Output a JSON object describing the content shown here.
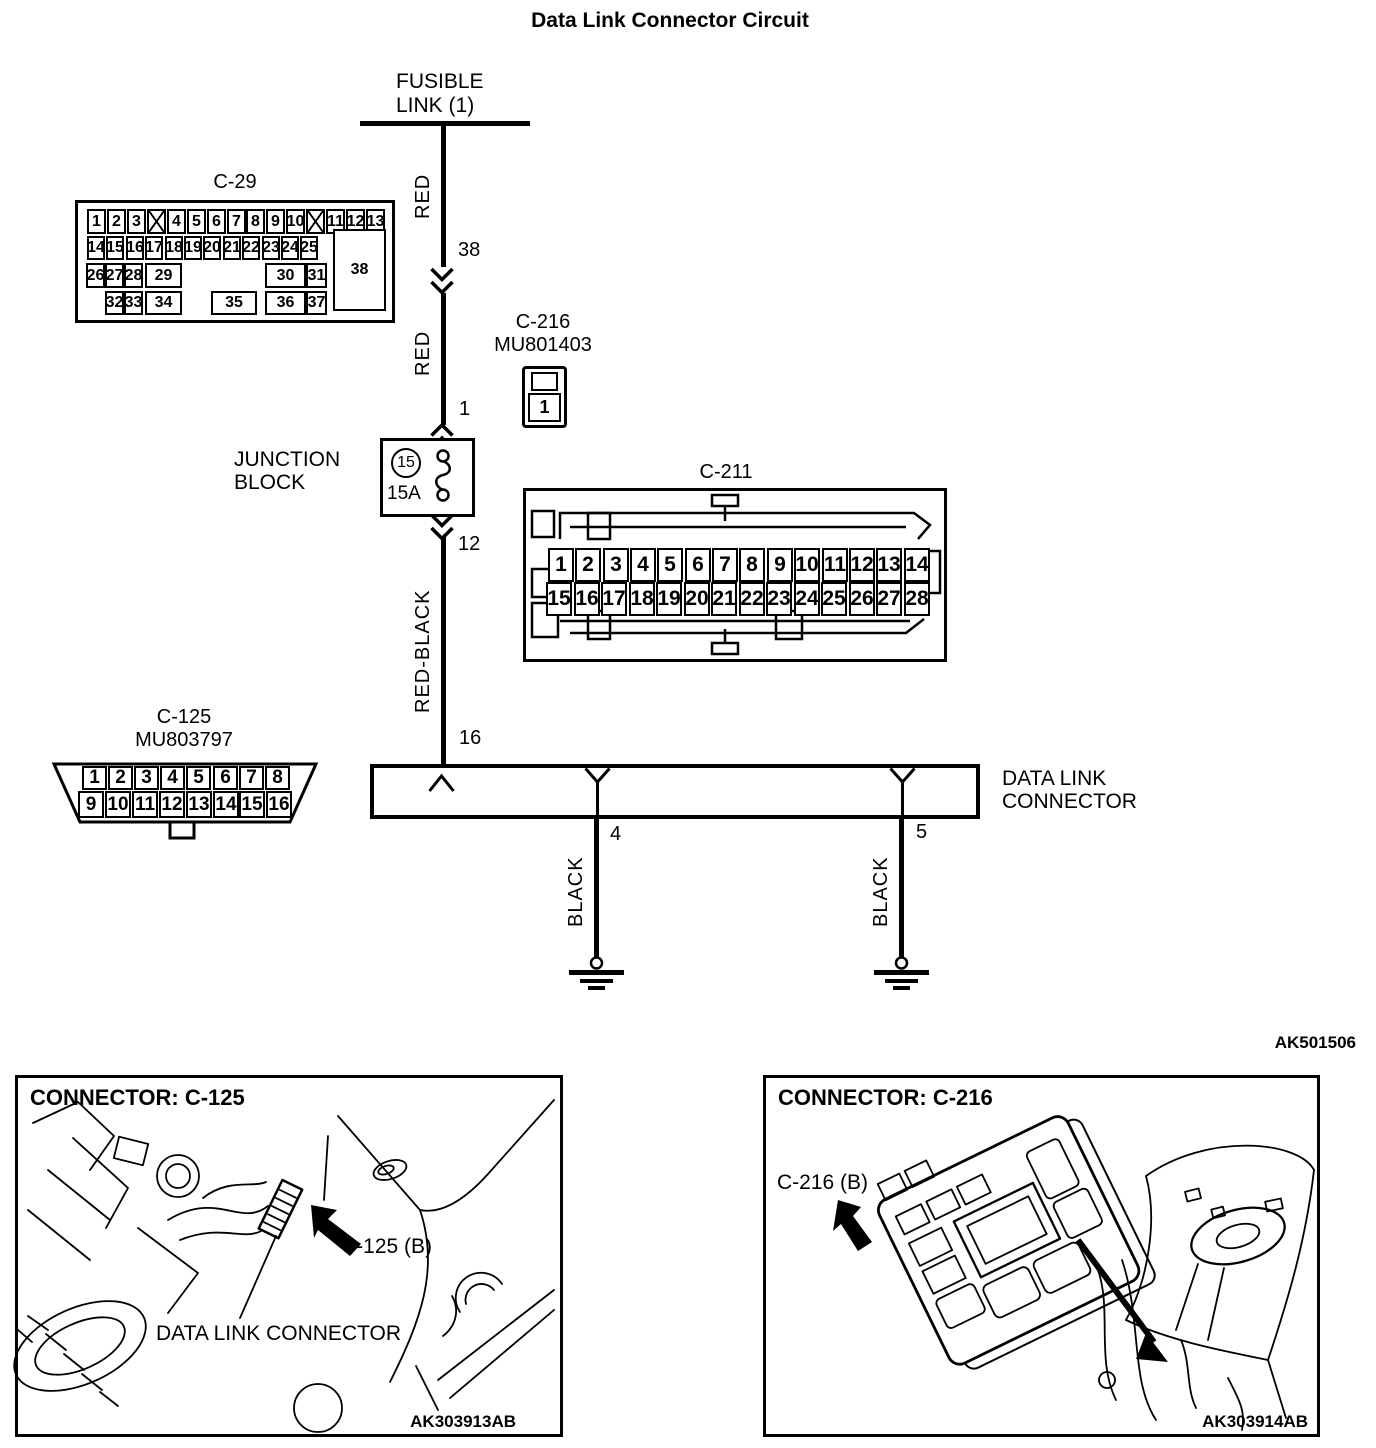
{
  "title": "Data Link Connector Circuit",
  "diagram_code": "AK501506",
  "fusible_link": {
    "line1": "FUSIBLE",
    "line2": "LINK (1)"
  },
  "wire_labels": {
    "red_upper": "RED",
    "red_lower": "RED",
    "red_black": "RED-BLACK",
    "black_left": "BLACK",
    "black_right": "BLACK"
  },
  "wire_pins": {
    "c29_pin": "38",
    "c216_pin": "1",
    "jb_out_pin": "12",
    "dlc_in_pin": "16",
    "ground_left_pin": "4",
    "ground_right_pin": "5"
  },
  "junction_block": {
    "line1": "JUNCTION",
    "line2": "BLOCK",
    "fuse_number": "15",
    "fuse_rating": "15A"
  },
  "dlc": {
    "line1": "DATA LINK",
    "line2": "CONNECTOR"
  },
  "connectors": {
    "c29": {
      "title": "C-29",
      "row1": [
        "1",
        "2",
        "3",
        "X",
        "4",
        "5",
        "6",
        "7",
        "8",
        "9",
        "10",
        "X",
        "11",
        "12",
        "13"
      ],
      "row2": [
        "14",
        "15",
        "16",
        "17",
        "18",
        "19",
        "20",
        "21",
        "22",
        "23",
        "24",
        "25"
      ],
      "row3": [
        "26",
        "27",
        "28",
        "29",
        "30",
        "31"
      ],
      "row4": [
        "32",
        "33",
        "34",
        "35",
        "36",
        "37"
      ],
      "pin38": "38"
    },
    "c216": {
      "title": "C-216",
      "part_number": "MU801403",
      "pin": "1"
    },
    "c211": {
      "title": "C-211",
      "row1": [
        "1",
        "2",
        "3",
        "4",
        "5",
        "6",
        "7",
        "8",
        "9",
        "10",
        "11",
        "12",
        "13",
        "14"
      ],
      "row2": [
        "15",
        "16",
        "17",
        "18",
        "19",
        "20",
        "21",
        "22",
        "23",
        "24",
        "25",
        "26",
        "27",
        "28"
      ]
    },
    "c125": {
      "title": "C-125",
      "part_number": "MU803797",
      "row1": [
        "1",
        "2",
        "3",
        "4",
        "5",
        "6",
        "7",
        "8"
      ],
      "row2": [
        "9",
        "10",
        "11",
        "12",
        "13",
        "14",
        "15",
        "16"
      ]
    }
  },
  "photo_c125": {
    "header": "CONNECTOR: C-125",
    "callout": "C-125 (B)",
    "caption": "DATA LINK CONNECTOR",
    "code": "AK303913AB"
  },
  "photo_c216": {
    "header": "CONNECTOR: C-216",
    "callout": "C-216 (B)",
    "code": "AK303914AB"
  }
}
